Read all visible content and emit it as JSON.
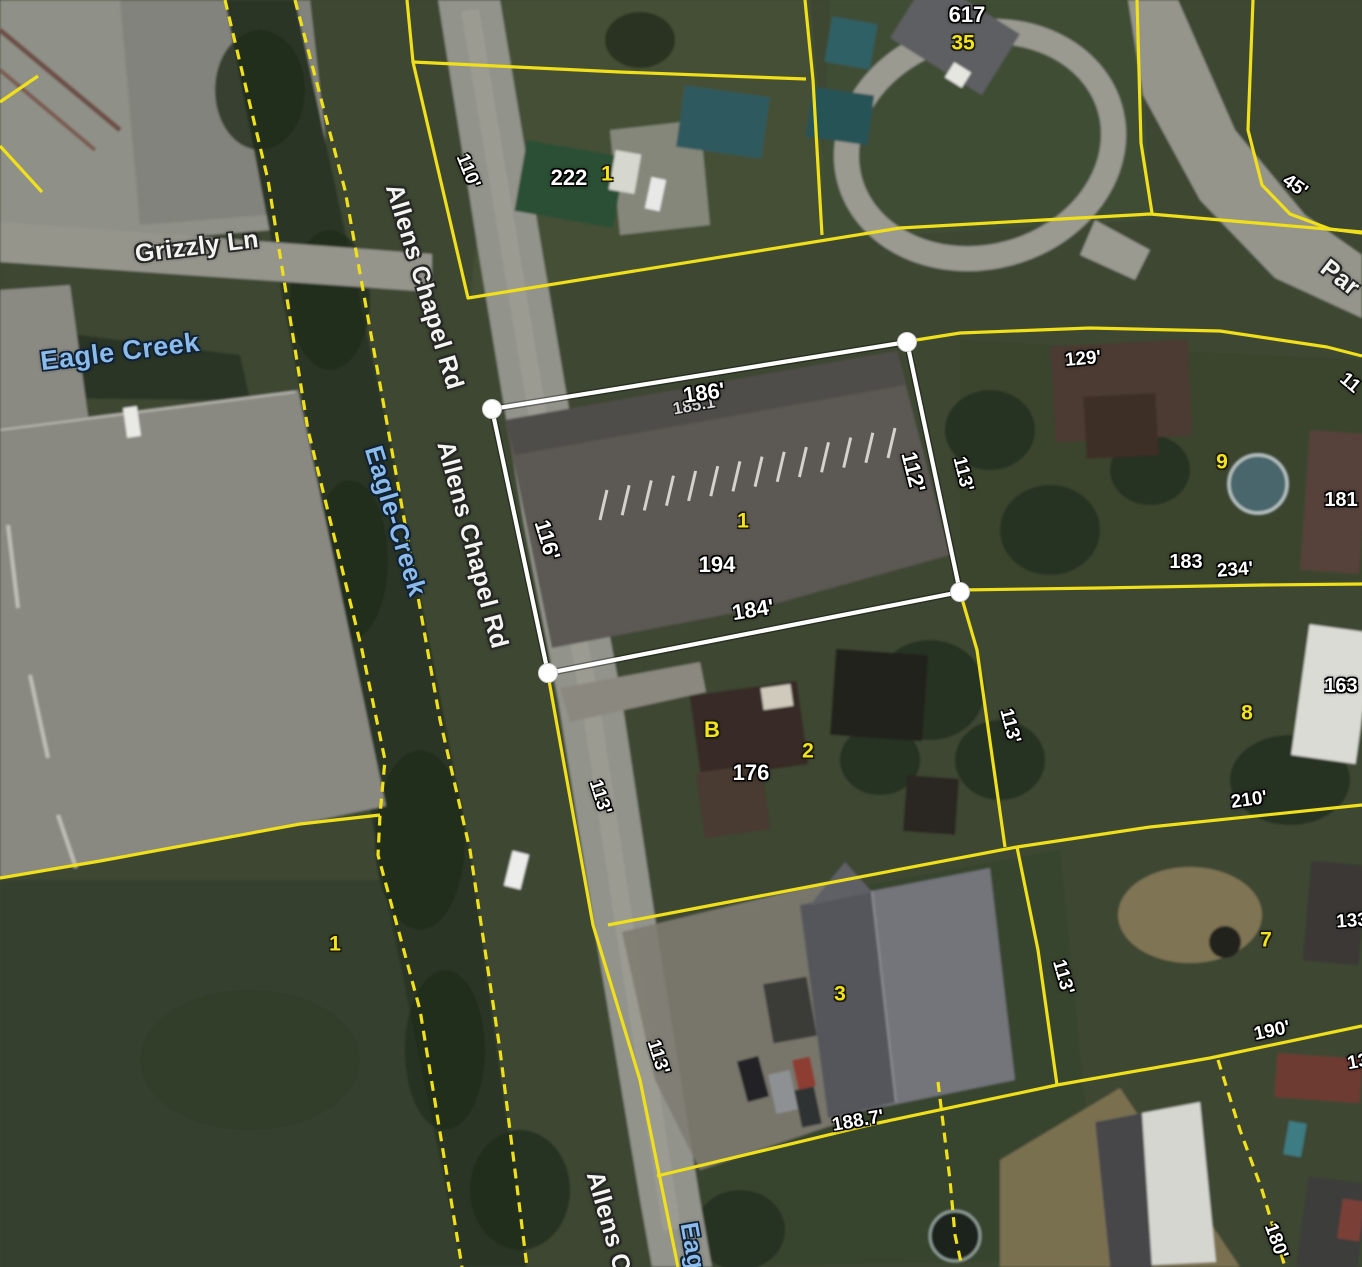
{
  "map": {
    "colors": {
      "parcel_line": "#f0df1b",
      "selected_parcel_line": "#ffffff",
      "water_text": "#8cbae9",
      "lot_number_text": "#f4e41e",
      "dimension_text": "#ffffff"
    },
    "selected_parcel": {
      "address": "194",
      "lot_number": "1",
      "vertices": [
        [
          907,
          342
        ],
        [
          960,
          592
        ],
        [
          548,
          673
        ],
        [
          492,
          409
        ]
      ]
    },
    "street_labels": [
      {
        "text": "Grizzly Ln",
        "x": 197,
        "y": 247,
        "rot": -7,
        "size": 25
      },
      {
        "text": "Allens Chapel Rd",
        "x": 424,
        "y": 287,
        "rot": 73,
        "size": 25
      },
      {
        "text": "Allens Chapel Rd",
        "x": 472,
        "y": 545,
        "rot": 75,
        "size": 25
      },
      {
        "text": "Allens C",
        "x": 608,
        "y": 1222,
        "rot": 74,
        "size": 25
      },
      {
        "text": "Par",
        "x": 1340,
        "y": 278,
        "rot": 38,
        "size": 25
      }
    ],
    "water_labels": [
      {
        "text": "Eagle Creek",
        "x": 120,
        "y": 352,
        "rot": -7,
        "size": 27
      },
      {
        "text": "Eagle-Creek",
        "x": 396,
        "y": 521,
        "rot": 73,
        "size": 26
      },
      {
        "text": "Eag",
        "x": 692,
        "y": 1246,
        "rot": 80,
        "size": 25
      }
    ],
    "dimension_labels": [
      {
        "text": "110'",
        "x": 468,
        "y": 171,
        "rot": 68,
        "size": 19
      },
      {
        "text": "45'",
        "x": 1295,
        "y": 186,
        "rot": 35,
        "size": 19
      },
      {
        "text": "185.1'",
        "x": 696,
        "y": 405,
        "rot": -10,
        "size": 17,
        "faint": true
      },
      {
        "text": "186'",
        "x": 704,
        "y": 393,
        "rot": -8,
        "size": 22
      },
      {
        "text": "112'",
        "x": 913,
        "y": 472,
        "rot": 76,
        "size": 22
      },
      {
        "text": "113'",
        "x": 963,
        "y": 474,
        "rot": 76,
        "size": 19
      },
      {
        "text": "116'",
        "x": 547,
        "y": 540,
        "rot": 73,
        "size": 22
      },
      {
        "text": "184'",
        "x": 753,
        "y": 610,
        "rot": -9,
        "size": 22
      },
      {
        "text": "129'",
        "x": 1083,
        "y": 359,
        "rot": -5,
        "size": 19
      },
      {
        "text": "234'",
        "x": 1235,
        "y": 570,
        "rot": -4,
        "size": 19
      },
      {
        "text": "113'",
        "x": 600,
        "y": 797,
        "rot": 72,
        "size": 19
      },
      {
        "text": "113'",
        "x": 1010,
        "y": 726,
        "rot": 75,
        "size": 19
      },
      {
        "text": "210'",
        "x": 1249,
        "y": 800,
        "rot": -8,
        "size": 19
      },
      {
        "text": "113'",
        "x": 658,
        "y": 1057,
        "rot": 72,
        "size": 19
      },
      {
        "text": "113'",
        "x": 1063,
        "y": 977,
        "rot": 74,
        "size": 19
      },
      {
        "text": "188.7'",
        "x": 858,
        "y": 1121,
        "rot": -10,
        "size": 19
      },
      {
        "text": "190'",
        "x": 1272,
        "y": 1031,
        "rot": -12,
        "size": 19
      },
      {
        "text": "180'",
        "x": 1276,
        "y": 1241,
        "rot": 70,
        "size": 19
      },
      {
        "text": "133",
        "x": 1352,
        "y": 921,
        "rot": -4,
        "size": 19
      },
      {
        "text": "13",
        "x": 1358,
        "y": 1062,
        "rot": -10,
        "size": 19
      },
      {
        "text": "11",
        "x": 1350,
        "y": 383,
        "rot": 40,
        "size": 19
      }
    ],
    "address_labels": [
      {
        "text": "222",
        "x": 569,
        "y": 178,
        "size": 22
      },
      {
        "text": "617",
        "x": 967,
        "y": 15,
        "size": 22
      },
      {
        "text": "194",
        "x": 717,
        "y": 565,
        "size": 22
      },
      {
        "text": "176",
        "x": 751,
        "y": 773,
        "size": 22
      },
      {
        "text": "183",
        "x": 1186,
        "y": 562,
        "size": 20
      },
      {
        "text": "181",
        "x": 1341,
        "y": 500,
        "size": 20
      },
      {
        "text": "163",
        "x": 1341,
        "y": 686,
        "size": 20
      }
    ],
    "lot_numbers": [
      {
        "text": "1",
        "x": 607,
        "y": 174,
        "size": 21
      },
      {
        "text": "35",
        "x": 963,
        "y": 43,
        "size": 21
      },
      {
        "text": "9",
        "x": 1222,
        "y": 462,
        "size": 21
      },
      {
        "text": "1",
        "x": 743,
        "y": 521,
        "size": 21
      },
      {
        "text": "B",
        "x": 712,
        "y": 730,
        "size": 22
      },
      {
        "text": "2",
        "x": 808,
        "y": 751,
        "size": 21
      },
      {
        "text": "8",
        "x": 1247,
        "y": 713,
        "size": 21
      },
      {
        "text": "1",
        "x": 335,
        "y": 944,
        "size": 21
      },
      {
        "text": "3",
        "x": 840,
        "y": 994,
        "size": 21
      },
      {
        "text": "7",
        "x": 1266,
        "y": 940,
        "size": 21
      }
    ],
    "parcel_lines": {
      "solid": [
        [
          [
            38,
            76
          ],
          [
            0,
            102
          ]
        ],
        [
          [
            0,
            146
          ],
          [
            42,
            192
          ]
        ],
        [
          [
            407,
            0
          ],
          [
            413,
            62
          ],
          [
            468,
            298
          ],
          [
            900,
            228
          ]
        ],
        [
          [
            413,
            62
          ],
          [
            620,
            72
          ],
          [
            806,
            79
          ]
        ],
        [
          [
            805,
            0
          ],
          [
            813,
            80
          ],
          [
            822,
            235
          ]
        ],
        [
          [
            900,
            228
          ],
          [
            1150,
            214
          ],
          [
            1362,
            232
          ]
        ],
        [
          [
            1137,
            0
          ],
          [
            1141,
            143
          ],
          [
            1152,
            213
          ]
        ],
        [
          [
            1253,
            0
          ],
          [
            1248,
            130
          ],
          [
            1262,
            185
          ],
          [
            1290,
            214
          ],
          [
            1330,
            229
          ],
          [
            1362,
            233
          ]
        ],
        [
          [
            910,
            341
          ],
          [
            960,
            333
          ],
          [
            1090,
            328
          ],
          [
            1220,
            331
          ],
          [
            1327,
            347
          ],
          [
            1362,
            356
          ]
        ],
        [
          [
            960,
            590
          ],
          [
            1100,
            588
          ],
          [
            1263,
            585
          ],
          [
            1362,
            584
          ]
        ],
        [
          [
            548,
            675
          ],
          [
            593,
            925
          ],
          [
            640,
            1080
          ],
          [
            678,
            1267
          ]
        ],
        [
          [
            608,
            925
          ],
          [
            1017,
            847
          ]
        ],
        [
          [
            960,
            592
          ],
          [
            977,
            650
          ],
          [
            1005,
            847
          ]
        ],
        [
          [
            1017,
            847
          ],
          [
            1150,
            827
          ],
          [
            1362,
            805
          ]
        ],
        [
          [
            1017,
            847
          ],
          [
            1038,
            950
          ],
          [
            1057,
            1085
          ]
        ],
        [
          [
            657,
            1176
          ],
          [
            878,
            1123
          ],
          [
            1057,
            1085
          ],
          [
            1210,
            1058
          ],
          [
            1362,
            1026
          ]
        ],
        [
          [
            380,
            815
          ],
          [
            300,
            824
          ],
          [
            100,
            861
          ],
          [
            0,
            878
          ]
        ]
      ],
      "dashed": [
        [
          [
            225,
            0
          ],
          [
            268,
            180
          ],
          [
            308,
            430
          ],
          [
            362,
            650
          ],
          [
            385,
            760
          ],
          [
            380,
            815
          ],
          [
            378,
            855
          ],
          [
            420,
            1010
          ],
          [
            462,
            1267
          ]
        ],
        [
          [
            295,
            0
          ],
          [
            345,
            190
          ],
          [
            390,
            440
          ],
          [
            440,
            720
          ],
          [
            470,
            850
          ],
          [
            500,
            1050
          ],
          [
            527,
            1267
          ]
        ],
        [
          [
            938,
            1082
          ],
          [
            950,
            1180
          ],
          [
            955,
            1235
          ],
          [
            962,
            1267
          ]
        ],
        [
          [
            1218,
            1060
          ],
          [
            1240,
            1130
          ],
          [
            1262,
            1190
          ],
          [
            1285,
            1267
          ]
        ]
      ]
    }
  }
}
